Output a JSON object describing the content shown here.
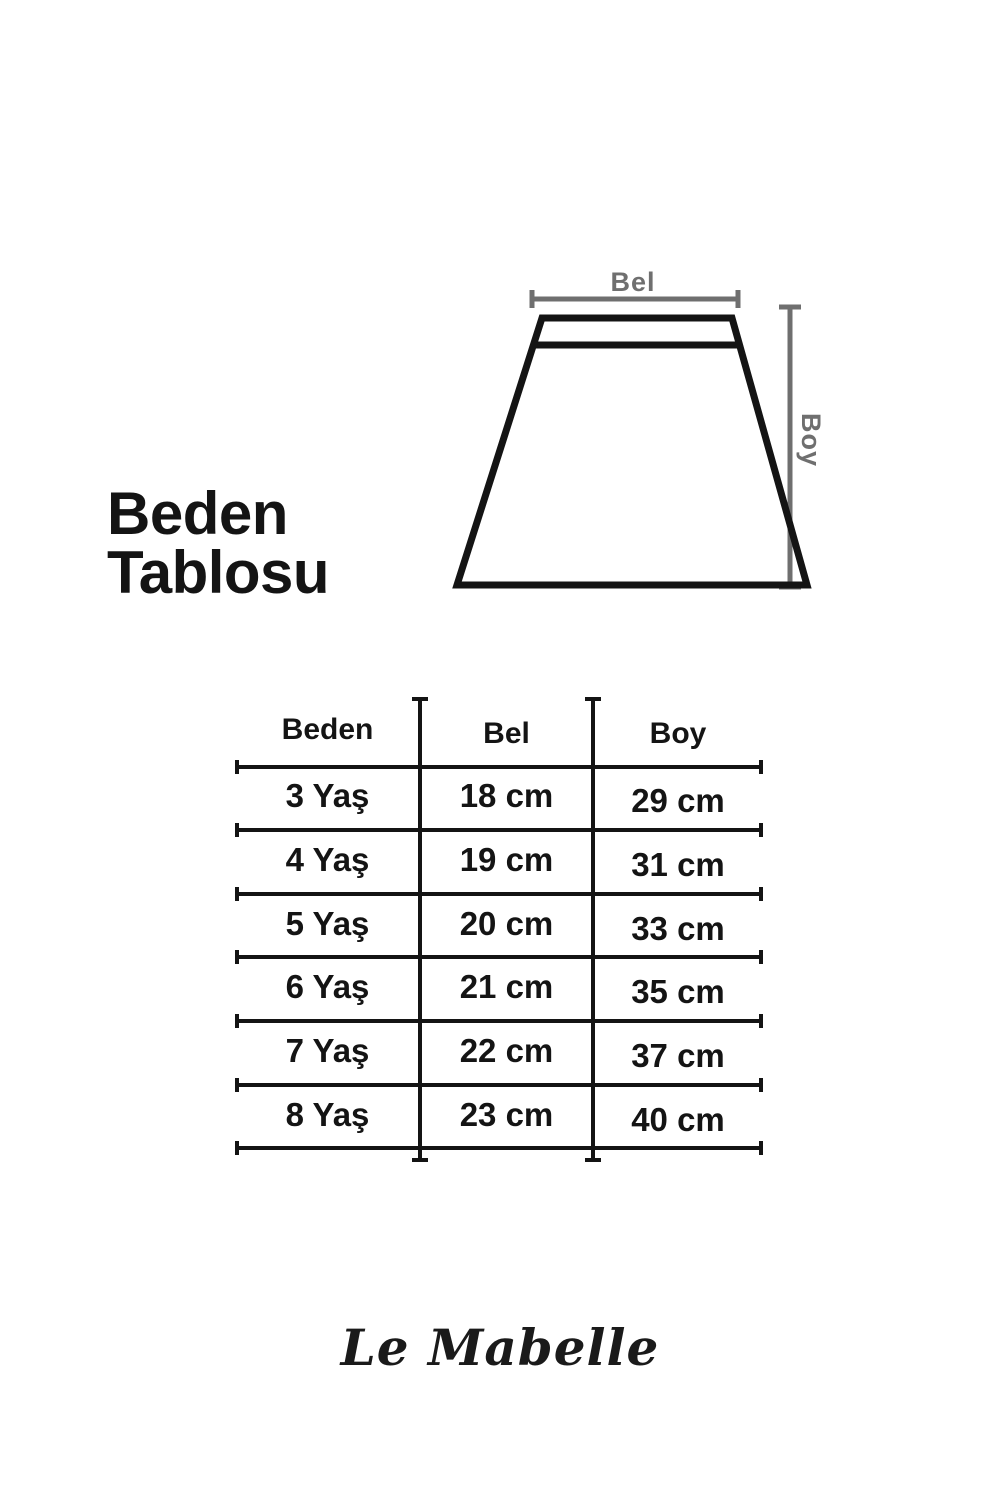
{
  "colors": {
    "line_black": "#141414",
    "dimension_gray": "#6f6f6f",
    "background": "#ffffff"
  },
  "title": {
    "line1": "Beden",
    "line2": "Tablosu"
  },
  "diagram": {
    "shape": "skirt-trapezoid-outline",
    "waist_label": "Bel",
    "length_label": "Boy"
  },
  "table": {
    "headers": {
      "size": "Beden",
      "waist": "Bel",
      "length": "Boy"
    },
    "rows": [
      {
        "size": "3 Yaş",
        "waist": "18 cm",
        "length": "29 cm"
      },
      {
        "size": "4 Yaş",
        "waist": "19 cm",
        "length": "31 cm"
      },
      {
        "size": "5 Yaş",
        "waist": "20 cm",
        "length": "33 cm"
      },
      {
        "size": "6 Yaş",
        "waist": "21 cm",
        "length": "35 cm"
      },
      {
        "size": "7 Yaş",
        "waist": "22 cm",
        "length": "37 cm"
      },
      {
        "size": "8 Yaş",
        "waist": "23 cm",
        "length": "40 cm"
      }
    ]
  },
  "logo": {
    "text": "Le Mabelle"
  }
}
